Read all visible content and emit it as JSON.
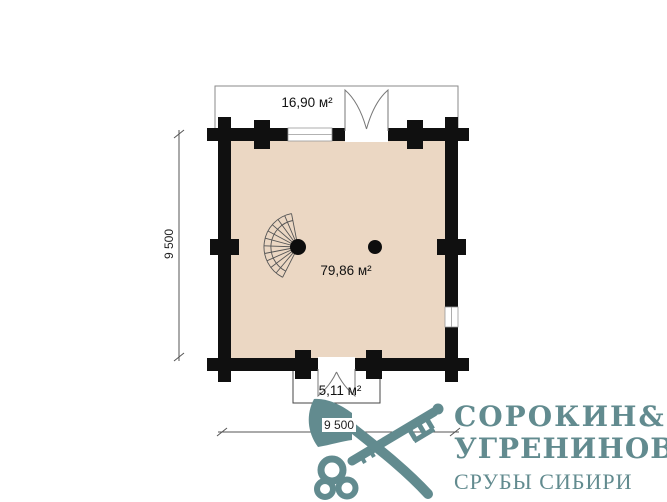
{
  "plan": {
    "terrace_area_label": "16,90 м²",
    "room_area_label": "79,86 м²",
    "porch_area_label": "5,11 м²",
    "left_dimension": "9 500",
    "bottom_dimension": "9 500"
  },
  "logo": {
    "name_line1": "СОРОКИН",
    "ampersand": "&",
    "name_line2": "УГРЕНИНОВ",
    "tagline": "СРУБЫ СИБИРИ",
    "brand_color": "#628b8f"
  },
  "colors": {
    "wall": "#101010",
    "floor_fill": "#ebd7c3",
    "line": "#555555"
  }
}
